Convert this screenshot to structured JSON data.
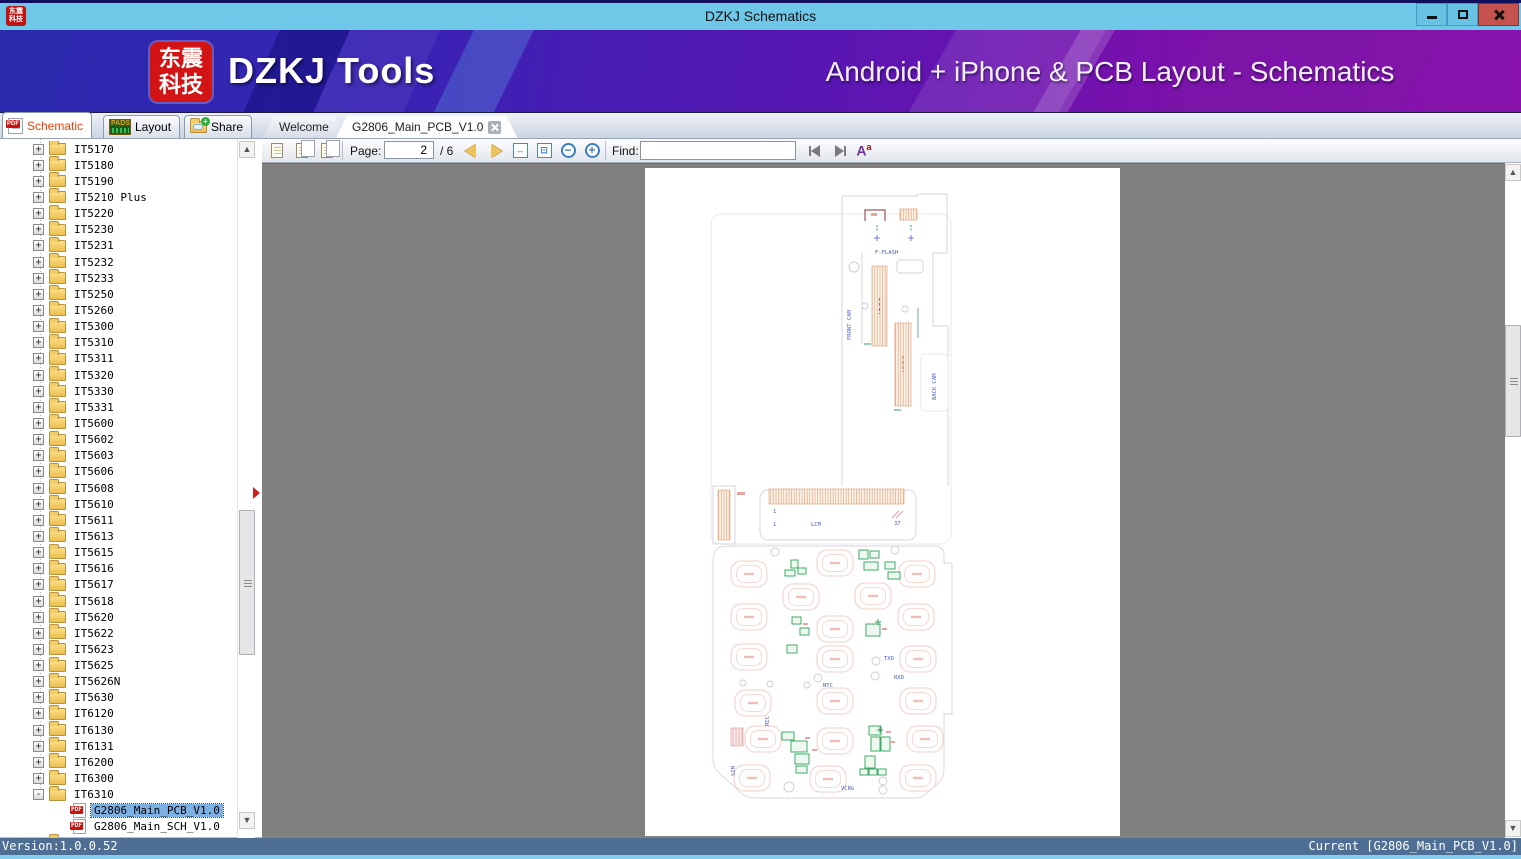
{
  "window": {
    "title": "DZKJ Schematics",
    "logo_line1": "东震",
    "logo_line2": "科技"
  },
  "banner": {
    "logo_line1": "东震",
    "logo_line2": "科技",
    "brand": "DZKJ Tools",
    "tagline": "Android + iPhone & PCB Layout - Schematics"
  },
  "tabs": {
    "mode": [
      {
        "label": "Schematic"
      },
      {
        "label": "Layout"
      },
      {
        "label": "Share"
      }
    ],
    "docs": [
      {
        "label": "Welcome"
      },
      {
        "label": "G2806_Main_PCB_V1.0"
      }
    ]
  },
  "toolbar": {
    "page_label": "Page:",
    "page_value": "2",
    "page_total": "/ 6",
    "find_label": "Find:",
    "find_value": ""
  },
  "icons": {
    "pdf_label": "PDF",
    "pads_label": "PADS",
    "case_a": "A",
    "case_sup": "a"
  },
  "sidebar": {
    "items": [
      {
        "label": "IT5170",
        "type": "folder",
        "state": "+",
        "child": false,
        "selected": false,
        "badge": ""
      },
      {
        "label": "IT5180",
        "type": "folder",
        "state": "+",
        "child": false,
        "selected": false,
        "badge": ""
      },
      {
        "label": "IT5190",
        "type": "folder",
        "state": "+",
        "child": false,
        "selected": false,
        "badge": ""
      },
      {
        "label": "IT5210 Plus",
        "type": "folder",
        "state": "+",
        "child": false,
        "selected": false,
        "badge": ""
      },
      {
        "label": "IT5220",
        "type": "folder",
        "state": "+",
        "child": false,
        "selected": false,
        "badge": ""
      },
      {
        "label": "IT5230",
        "type": "folder",
        "state": "+",
        "child": false,
        "selected": false,
        "badge": ""
      },
      {
        "label": "IT5231",
        "type": "folder",
        "state": "+",
        "child": false,
        "selected": false,
        "badge": ""
      },
      {
        "label": "IT5232",
        "type": "folder",
        "state": "+",
        "child": false,
        "selected": false,
        "badge": ""
      },
      {
        "label": "IT5233",
        "type": "folder",
        "state": "+",
        "child": false,
        "selected": false,
        "badge": ""
      },
      {
        "label": "IT5250",
        "type": "folder",
        "state": "+",
        "child": false,
        "selected": false,
        "badge": ""
      },
      {
        "label": "IT5260",
        "type": "folder",
        "state": "+",
        "child": false,
        "selected": false,
        "badge": ""
      },
      {
        "label": "IT5300",
        "type": "folder",
        "state": "+",
        "child": false,
        "selected": false,
        "badge": ""
      },
      {
        "label": "IT5310",
        "type": "folder",
        "state": "+",
        "child": false,
        "selected": false,
        "badge": ""
      },
      {
        "label": "IT5311",
        "type": "folder",
        "state": "+",
        "child": false,
        "selected": false,
        "badge": ""
      },
      {
        "label": "IT5320",
        "type": "folder",
        "state": "+",
        "child": false,
        "selected": false,
        "badge": ""
      },
      {
        "label": "IT5330",
        "type": "folder",
        "state": "+",
        "child": false,
        "selected": false,
        "badge": ""
      },
      {
        "label": "IT5331",
        "type": "folder",
        "state": "+",
        "child": false,
        "selected": false,
        "badge": ""
      },
      {
        "label": "IT5600",
        "type": "folder",
        "state": "+",
        "child": false,
        "selected": false,
        "badge": ""
      },
      {
        "label": "IT5602",
        "type": "folder",
        "state": "+",
        "child": false,
        "selected": false,
        "badge": ""
      },
      {
        "label": "IT5603",
        "type": "folder",
        "state": "+",
        "child": false,
        "selected": false,
        "badge": ""
      },
      {
        "label": "IT5606",
        "type": "folder",
        "state": "+",
        "child": false,
        "selected": false,
        "badge": ""
      },
      {
        "label": "IT5608",
        "type": "folder",
        "state": "+",
        "child": false,
        "selected": false,
        "badge": ""
      },
      {
        "label": "IT5610",
        "type": "folder",
        "state": "+",
        "child": false,
        "selected": false,
        "badge": ""
      },
      {
        "label": "IT5611",
        "type": "folder",
        "state": "+",
        "child": false,
        "selected": false,
        "badge": ""
      },
      {
        "label": "IT5613",
        "type": "folder",
        "state": "+",
        "child": false,
        "selected": false,
        "badge": ""
      },
      {
        "label": "IT5615",
        "type": "folder",
        "state": "+",
        "child": false,
        "selected": false,
        "badge": ""
      },
      {
        "label": "IT5616",
        "type": "folder",
        "state": "+",
        "child": false,
        "selected": false,
        "badge": ""
      },
      {
        "label": "IT5617",
        "type": "folder",
        "state": "+",
        "child": false,
        "selected": false,
        "badge": ""
      },
      {
        "label": "IT5618",
        "type": "folder",
        "state": "+",
        "child": false,
        "selected": false,
        "badge": ""
      },
      {
        "label": "IT5620",
        "type": "folder",
        "state": "+",
        "child": false,
        "selected": false,
        "badge": ""
      },
      {
        "label": "IT5622",
        "type": "folder",
        "state": "+",
        "child": false,
        "selected": false,
        "badge": ""
      },
      {
        "label": "IT5623",
        "type": "folder",
        "state": "+",
        "child": false,
        "selected": false,
        "badge": ""
      },
      {
        "label": "IT5625",
        "type": "folder",
        "state": "+",
        "child": false,
        "selected": false,
        "badge": ""
      },
      {
        "label": "IT5626N",
        "type": "folder",
        "state": "+",
        "child": false,
        "selected": false,
        "badge": ""
      },
      {
        "label": "IT5630",
        "type": "folder",
        "state": "+",
        "child": false,
        "selected": false,
        "badge": ""
      },
      {
        "label": "IT6120",
        "type": "folder",
        "state": "+",
        "child": false,
        "selected": false,
        "badge": ""
      },
      {
        "label": "IT6130",
        "type": "folder",
        "state": "+",
        "child": false,
        "selected": false,
        "badge": ""
      },
      {
        "label": "IT6131",
        "type": "folder",
        "state": "+",
        "child": false,
        "selected": false,
        "badge": ""
      },
      {
        "label": "IT6200",
        "type": "folder",
        "state": "+",
        "child": false,
        "selected": false,
        "badge": ""
      },
      {
        "label": "IT6300",
        "type": "folder",
        "state": "+",
        "child": false,
        "selected": false,
        "badge": ""
      },
      {
        "label": "IT6310",
        "type": "folder",
        "state": "-",
        "child": false,
        "selected": false,
        "badge": ""
      },
      {
        "label": "G2806_Main_PCB_V1.0",
        "type": "pdf",
        "state": "",
        "child": true,
        "selected": true,
        "badge": "PDF"
      },
      {
        "label": "G2806_Main_SCH_V1.0",
        "type": "pdf",
        "state": "",
        "child": true,
        "selected": false,
        "badge": "PDF"
      },
      {
        "label": "",
        "type": "folder",
        "state": "+",
        "child": false,
        "selected": false,
        "badge": ""
      }
    ]
  },
  "pcb": {
    "labels": {
      "f_flash": "F-FLASH",
      "front_cam": "FRONT CAM",
      "back_cam": "BACK CAM",
      "lcm": "LCM",
      "pin1a": "1",
      "pin1b": "1",
      "pin37": "37",
      "txd": "TXD",
      "rxd": "RXD",
      "ntc": "NTC",
      "vcrg": "VCRG",
      "sim": "SIM",
      "mic": "MIC"
    }
  },
  "statusbar": {
    "version": "Version:1.0.0.52",
    "current": "Current [G2806_Main_PCB_V1.0]"
  }
}
